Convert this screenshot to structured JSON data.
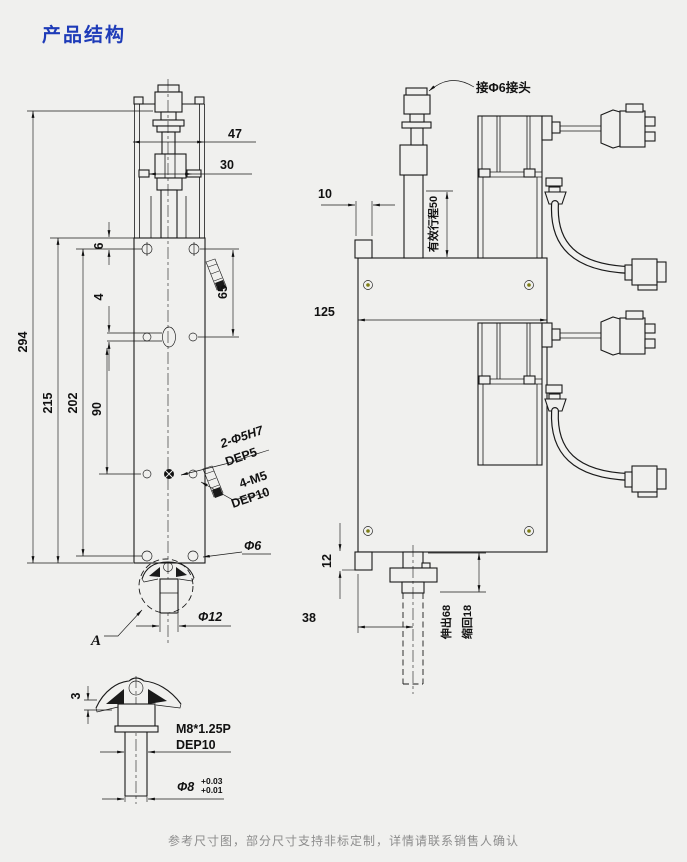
{
  "page": {
    "title": "产品结构",
    "note": "参考尺寸图，部分尺寸支持非标定制，详情请联系销售人确认"
  },
  "colors": {
    "bg": "#f0f0ee",
    "line": "#1a1a1a",
    "title": "#1e3bb8",
    "note": "#8c8c8c",
    "screw": "#7d7d15"
  },
  "left_view": {
    "dims": {
      "d294": "294",
      "d215": "215",
      "d202": "202",
      "d90": "90",
      "d65": "65",
      "d47": "47",
      "d30": "30",
      "d6": "6",
      "d4": "4",
      "phi12": "Φ12",
      "phi6": "Φ6"
    },
    "labels": {
      "pin_holes": "2-Φ5H7",
      "pin_depth": "DEP5",
      "tap_holes": "4-M5",
      "tap_depth": "DEP10",
      "detail_mark": "A"
    }
  },
  "detail_view": {
    "dims": {
      "d3": "3",
      "thread": "M8*1.25P",
      "thread_depth": "DEP10",
      "rod_dia": "Φ8",
      "tol_upper": "+0.03",
      "tol_lower": "+0.01"
    }
  },
  "right_view": {
    "dims": {
      "d10": "10",
      "d125": "125",
      "d12": "12",
      "d38": "38"
    },
    "labels": {
      "fitting": "接Φ6接头",
      "stroke": "有效行程50",
      "extend": "伸出68",
      "retract": "缩回18"
    }
  }
}
